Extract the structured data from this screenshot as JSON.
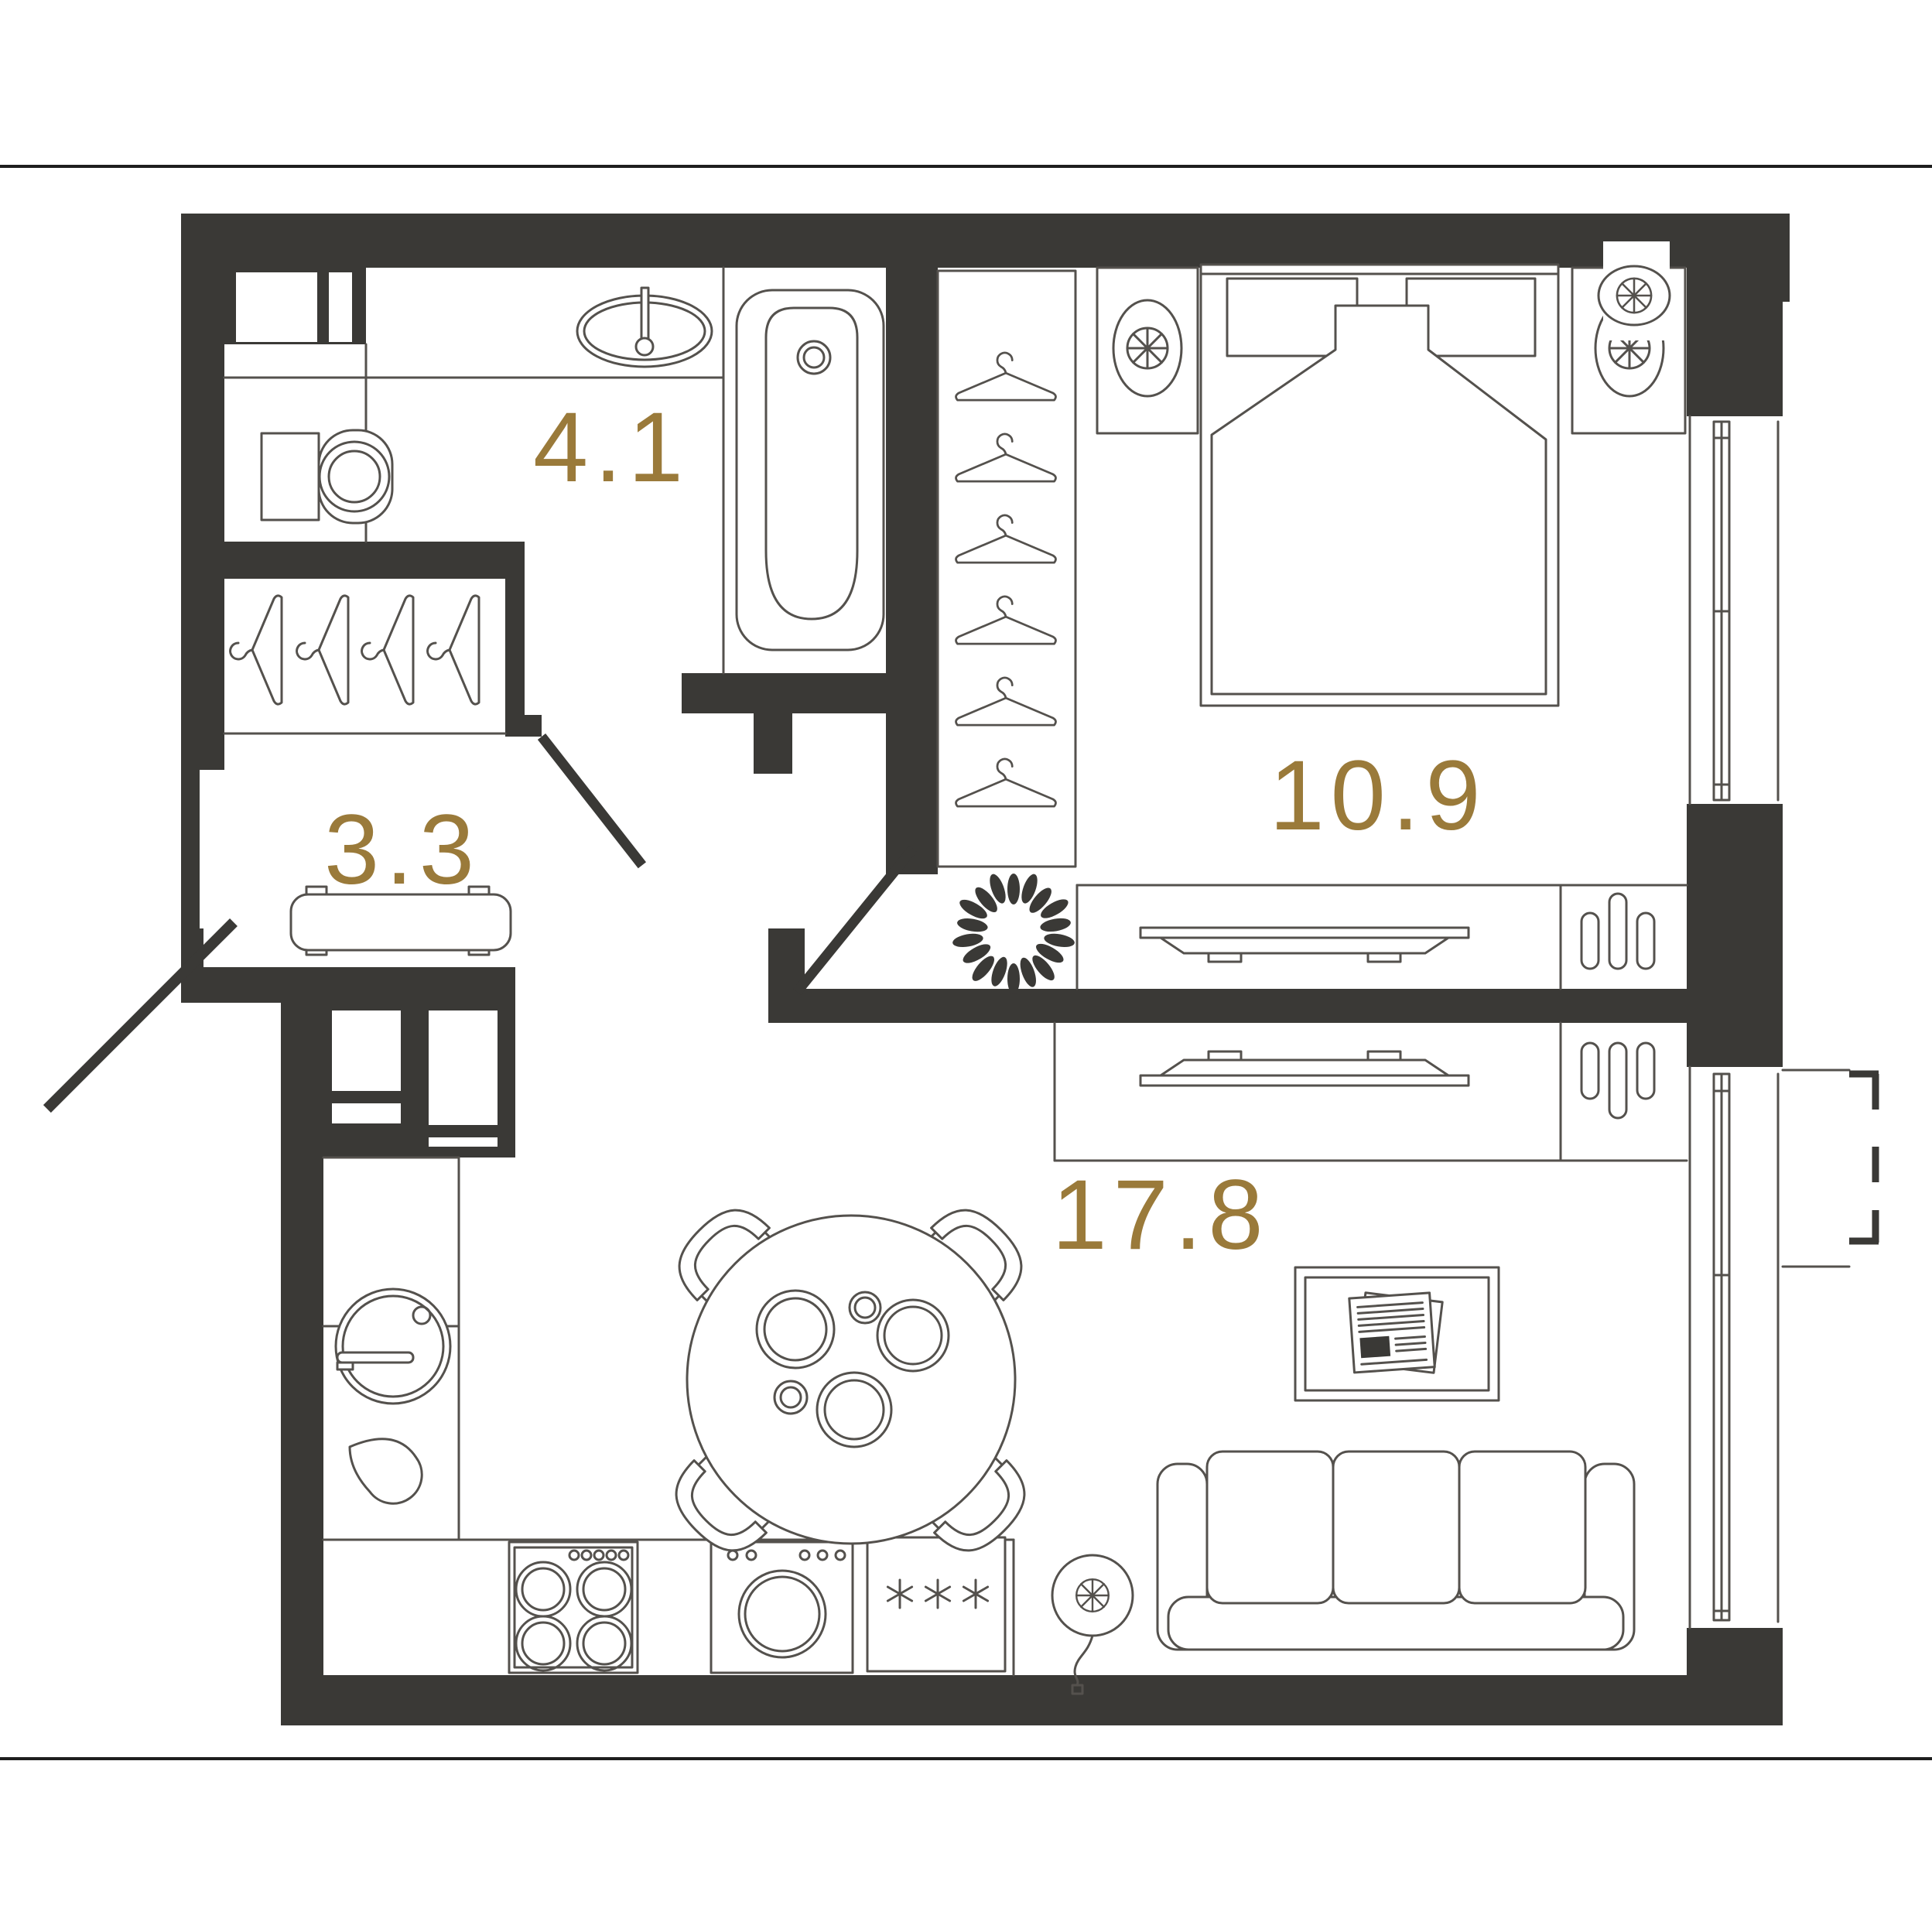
{
  "title": "One-room apartment floor plan",
  "colors": {
    "background": "#ffffff",
    "wall": "#3a3936",
    "furniture_line": "#54514d",
    "area_label": "#9a7a3a",
    "page_rule": "#1e1e1e"
  },
  "rooms": [
    {
      "id": "bathroom",
      "area_label": "4.1"
    },
    {
      "id": "hallway",
      "area_label": "3.3"
    },
    {
      "id": "bedroom",
      "area_label": "10.9"
    },
    {
      "id": "living-kitchen",
      "area_label": "17.8"
    }
  ],
  "icons": [
    "sink-icon",
    "toilet-icon",
    "bathtub-icon",
    "hanger-icon",
    "bench-icon",
    "door-swing-icon",
    "wardrobe-icon",
    "bed-icon",
    "pillow-icon",
    "nightstand-lamp-icon",
    "ac-fan-icon",
    "plant-icon",
    "dresser-icon",
    "tv-icon",
    "window-icon",
    "balcony-dashed-icon",
    "kitchen-sink-icon",
    "teardrop-icon",
    "stove-icon",
    "washing-machine-icon",
    "fridge-snowflake-icon",
    "fan-cord-icon",
    "dining-table-icon",
    "chair-icon",
    "plate-icon",
    "sofa-icon",
    "picture-newspaper-icon"
  ]
}
